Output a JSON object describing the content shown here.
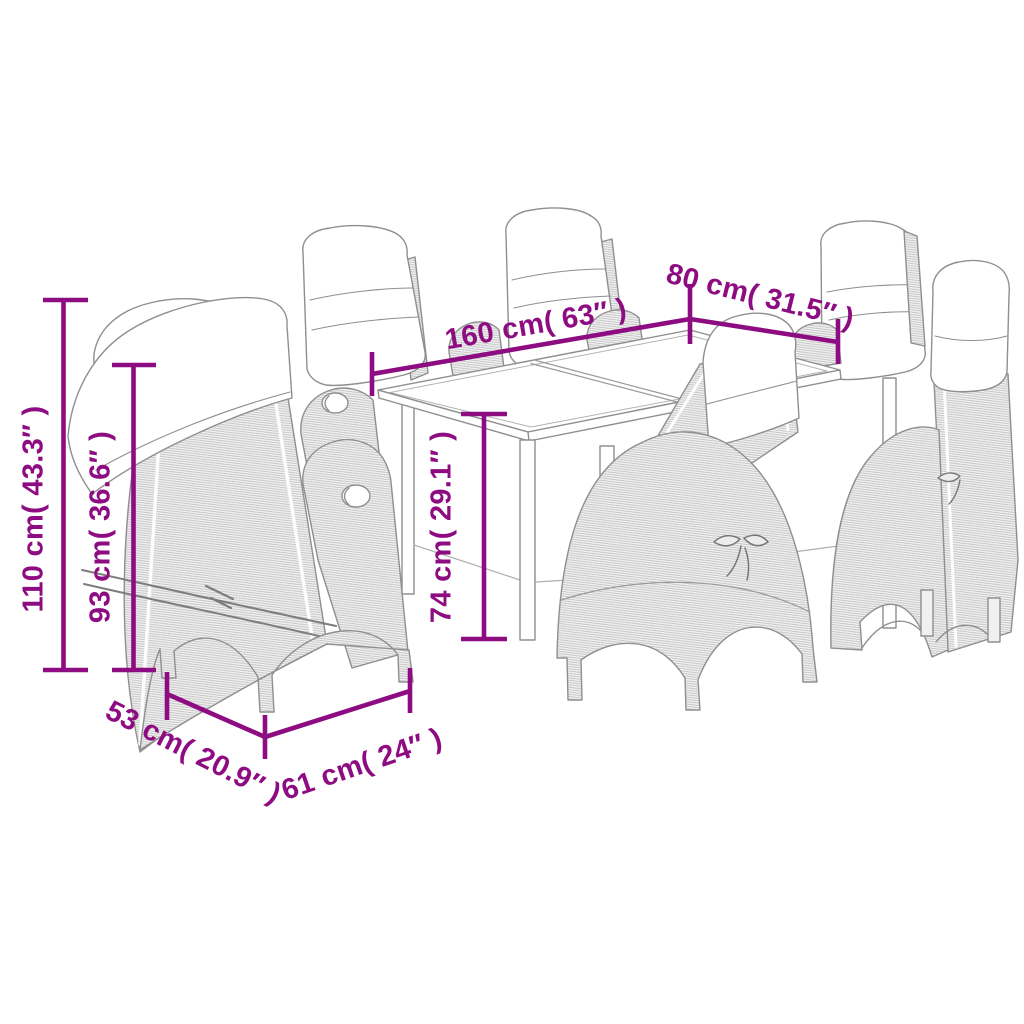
{
  "diagram": {
    "background_color": "#ffffff",
    "accent_color": "#8E0C82",
    "line_art_color": "#8f8f8f",
    "artwork": "Line drawing of a garden dining set: rectangular glass-top table with six reclining poly-rattan chairs with cushions",
    "dimensions": [
      {
        "id": "dim-110cm",
        "label": "110 cm( 43.3″ )",
        "cm": "110",
        "inches": "43.3",
        "orientation": "vertical"
      },
      {
        "id": "dim-93cm",
        "label": "93 cm( 36.6″ )",
        "cm": "93",
        "inches": "36.6",
        "orientation": "vertical"
      },
      {
        "id": "dim-160cm",
        "label": "160 cm( 63″ )",
        "cm": "160",
        "inches": "63",
        "orientation": "diagonal"
      },
      {
        "id": "dim-80cm",
        "label": "80 cm( 31.5″ )",
        "cm": "80",
        "inches": "31.5",
        "orientation": "diagonal"
      },
      {
        "id": "dim-74cm",
        "label": "74 cm( 29.1″ )",
        "cm": "74",
        "inches": "29.1",
        "orientation": "vertical"
      },
      {
        "id": "dim-53cm",
        "label": "53 cm( 20.9″ )",
        "cm": "53",
        "inches": "20.9",
        "orientation": "diagonal"
      },
      {
        "id": "dim-61cm",
        "label": "61 cm( 24″ )",
        "cm": "61",
        "inches": "24",
        "orientation": "diagonal"
      }
    ]
  }
}
